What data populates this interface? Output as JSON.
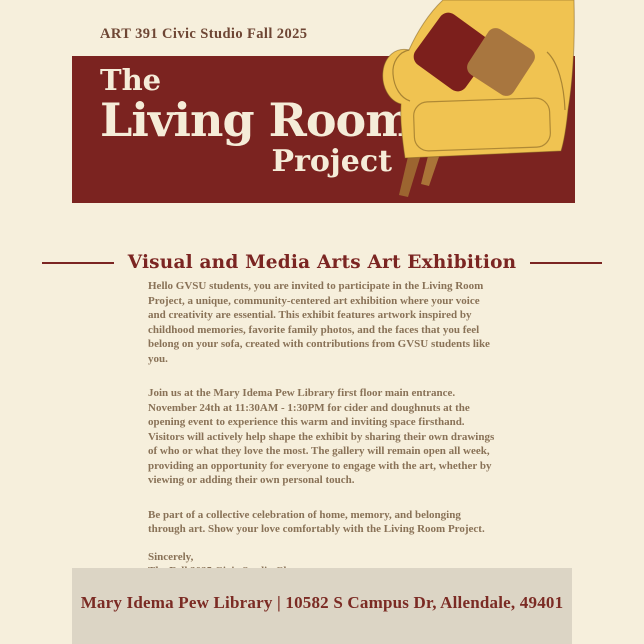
{
  "poster": {
    "kicker": "ART 391 Civic Studio Fall 2025",
    "title": {
      "line1": "The",
      "line2": "Living Room",
      "line3": "Project"
    },
    "heading": "Visual and Media Arts Art Exhibition",
    "body": {
      "paragraphs": [
        "Hello GVSU students, you are invited to participate in the Living Room Project, a unique, community-centered art exhibition where your voice and creativity are essential. This exhibit features artwork inspired by childhood memories, favorite family photos, and the faces that you feel belong on your sofa, created with contributions from GVSU students like you.",
        "Join us at the Mary Idema Pew Library first floor main entrance. November 24th at 11:30AM - 1:30PM for cider and doughnuts at the opening event to experience this warm and inviting space firsthand. Visitors will actively help shape the exhibit by sharing their own drawings of who or what they love the most. The gallery will remain open all week, providing an opportunity for everyone to engage with the art, whether by viewing or adding their own personal touch.",
        "Be part of a collective celebration of home, memory, and belonging through art. Show your love comfortably with the Living Room Project."
      ],
      "signoff_line1": "Sincerely,",
      "signoff_line2": "The Fall 2025 Civic Studio Class"
    },
    "footer": "Mary Idema Pew Library | 10582 S Campus Dr, Allendale, 49401",
    "illustration": "yellow-armchair-with-two-pillows",
    "colors": {
      "background": "#f6efdc",
      "banner_maroon": "#7b2320",
      "title_cream": "#f5ecd8",
      "heading_maroon": "#7b2522",
      "body_text": "#897257",
      "footer_band": "#dcd5c5",
      "sofa_yellow": "#f0c351",
      "pillow_maroon": "#7c1f1c",
      "pillow_tan": "#a8763f",
      "legs_brown": "#9c6530"
    }
  }
}
